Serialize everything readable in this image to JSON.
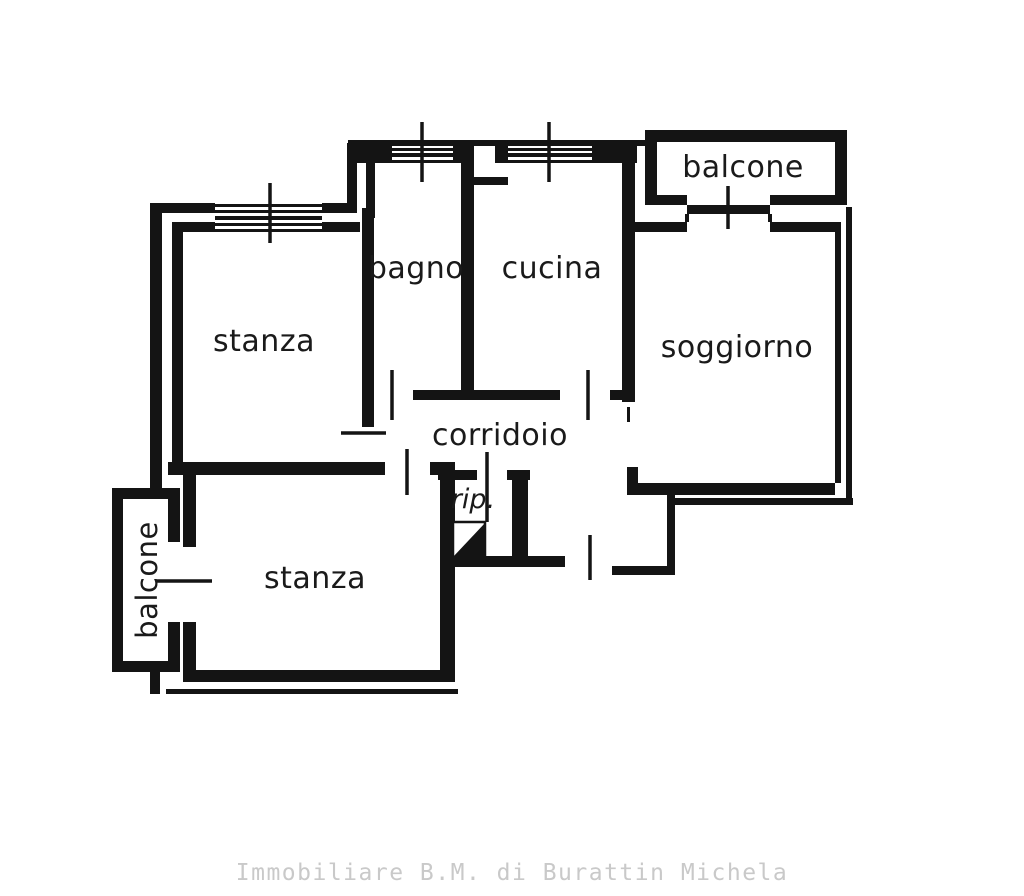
{
  "page": {
    "background": "#ffffff",
    "type": "real-estate floor plan scan"
  },
  "colors": {
    "wall_ink": "#141414",
    "label_ink": "#1a1a1a",
    "footer_gray": "#c9c9c9"
  },
  "floor_plan": {
    "rooms": {
      "stanza_top": "stanza",
      "bagno": "bagno",
      "cucina": "cucina",
      "soggiorno": "soggiorno",
      "corridoio": "corridoio",
      "rip": "rip.",
      "stanza_bottom": "stanza",
      "balcone_top": "balcone",
      "balcone_left": "balcone"
    }
  },
  "footer": {
    "agency": "Immobiliare B.M. di Burattin Michela"
  }
}
